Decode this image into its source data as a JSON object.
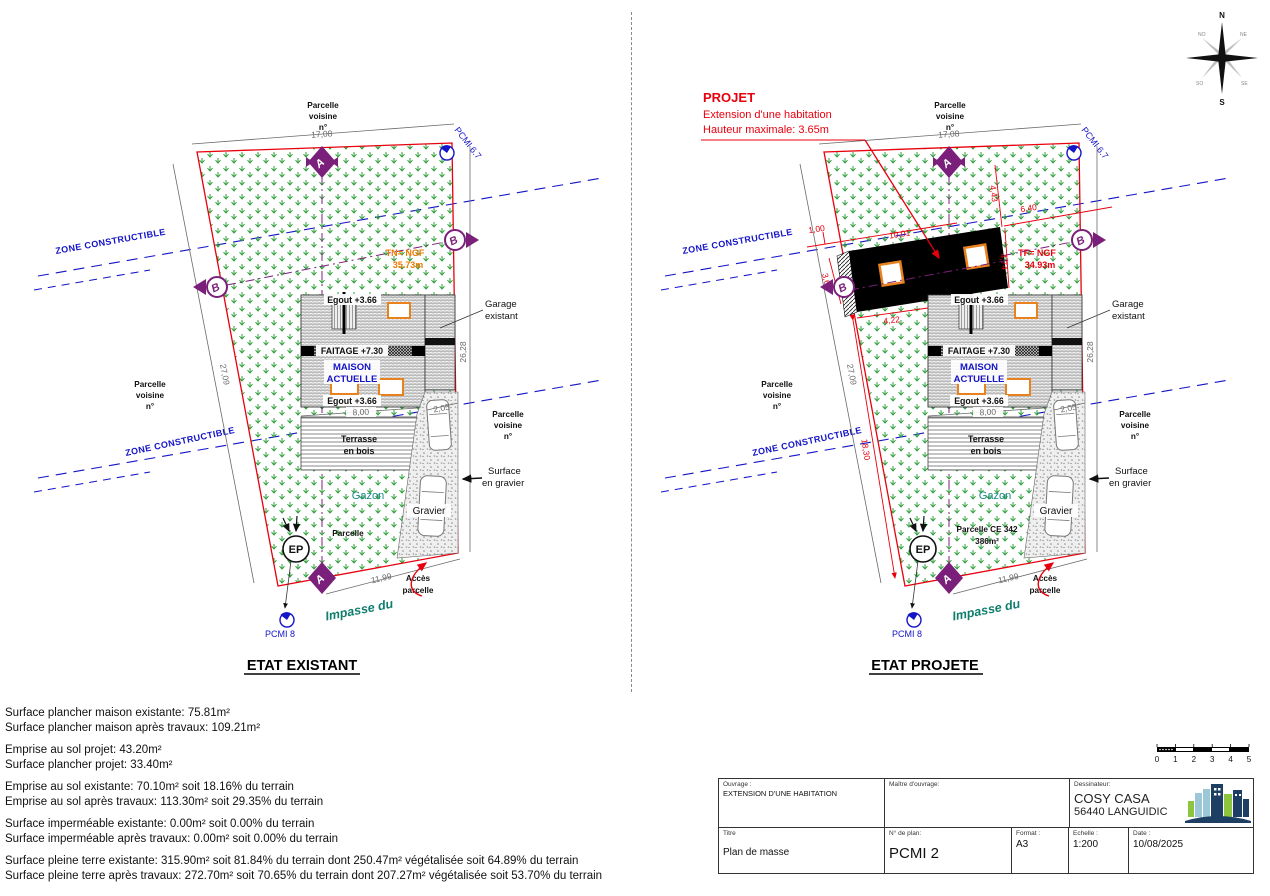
{
  "labels": {
    "parcelle_voisine_l1": "Parcelle",
    "parcelle_voisine_l2": "voisine",
    "parcelle_voisine_l3": "n°",
    "dim_17_08": "17,08",
    "dim_27_09": "27,09",
    "dim_26_28": "26,28",
    "dim_11_99": "11,99",
    "dim_8_00": "8,00",
    "dim_2_05": "2,05",
    "pcmi_6_7": "PCMI 6.7",
    "pcmi_8": "PCMI 8",
    "zone_constructible": "ZONE CONSTRUCTIBLE",
    "egout": "Egout +3.66",
    "faitage": "FAITAGE +7.30",
    "maison_l1": "MAISON",
    "maison_l2": "ACTUELLE",
    "garage_l1": "Garage",
    "garage_l2": "existant",
    "terrasse_l1": "Terrasse",
    "terrasse_l2": "en bois",
    "gazon": "Gazon",
    "gravier": "Gravier",
    "surface_gravier_l1": "Surface",
    "surface_gravier_l2": "en gravier",
    "acces_l1": "Accès",
    "acces_l2": "parcelle",
    "impasse": "Impasse du",
    "ep": "EP",
    "marker_a": "A",
    "marker_b": "B"
  },
  "existant": {
    "title": "ETAT EXISTANT",
    "tn_l1": "TN= NGF",
    "tn_l2": "35.73m",
    "parcelle": "Parcelle"
  },
  "projete": {
    "title": "ETAT PROJETE",
    "projet": "PROJET",
    "projet_l1": "Extension d'une habitation",
    "projet_l2": "Hauteur maximale: 3.65m",
    "tf_l1": "TF= NGF",
    "tf_l2": "34.93m",
    "parcelle_ce_l1": "Parcelle CE 342",
    "parcelle_ce_l2": "386m²",
    "dim_1_00": "1,00",
    "dim_10_01": "10,01",
    "dim_4_43": "4,43",
    "dim_6_40": "6,40",
    "dim_4_74": "4,74",
    "dim_3_64": "3,64",
    "dim_4_22": "4,22",
    "dim_18_30": "18,30"
  },
  "notes": {
    "g1l1": "Surface plancher maison existante: 75.81m²",
    "g1l2": "Surface plancher maison après travaux: 109.21m²",
    "g2l1": "Emprise au sol projet: 43.20m²",
    "g2l2": "Surface plancher projet: 33.40m²",
    "g3l1": "Emprise au sol existante: 70.10m² soit 18.16% du terrain",
    "g3l2": "Emprise au sol après travaux: 113.30m² soit 29.35% du terrain",
    "g4l1": "Surface imperméable existante: 0.00m² soit 0.00% du terrain",
    "g4l2": "Surface imperméable après travaux: 0.00m² soit 0.00% du terrain",
    "g5l1": "Surface pleine terre existante: 315.90m² soit 81.84% du terrain dont 250.47m² végétalisée soit 64.89% du terrain",
    "g5l2": "Surface pleine terre après travaux: 272.70m² soit 70.65% du terrain dont 207.27m² végétalisée soit 53.70% du terrain"
  },
  "title_block": {
    "ouvrage_label": "Ouvrage :",
    "ouvrage_value": "EXTENSION D'UNE HABITATION",
    "maitre_label": "Maître d'ouvrage:",
    "dessinateur_label": "Dessinateur:",
    "dessinateur_name": "COSY CASA",
    "dessinateur_city": "56440 LANGUIDIC",
    "titre_label": "Titre",
    "titre_value": "Plan de masse",
    "plan_num_label": "N° de plan:",
    "plan_num_value": "PCMI 2",
    "format_label": "Format :",
    "format_value": "A3",
    "echelle_label": "Echelle :",
    "echelle_value": "1:200",
    "date_label": "Date :",
    "date_value": "10/08/2025"
  },
  "scale": {
    "ticks": [
      "0",
      "1",
      "2",
      "3",
      "4",
      "5"
    ]
  },
  "compass": {
    "n": "N",
    "e": "E",
    "s": "S",
    "o": "O"
  },
  "colors": {
    "boundary_red": "#e8000d",
    "zone_blue": "#1414c8",
    "marker_purple": "#7a1f7a",
    "grass_green": "#2e9e3a",
    "orange_levels": "#f07800",
    "window_orange": "#e8821e",
    "teal_street": "#0e7d6b",
    "logo_navy": "#1d3f63",
    "logo_lightblue": "#9cc7d6",
    "logo_green": "#8cc63f"
  }
}
